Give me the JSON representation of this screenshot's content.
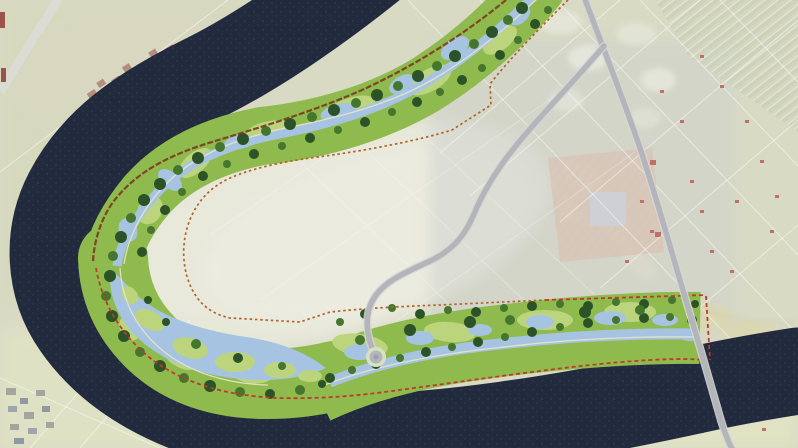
{
  "meta": {
    "view": "aerial-masterplan",
    "subject": "river-bend-wetland-park-plan-over-satellite-farmland",
    "visible_text": "none"
  },
  "palette": {
    "field-base": "#d2d4ba",
    "field-pale": "#e6e6d8",
    "field-gray": "#c8cac4",
    "field-yellow": "#e2e4bb",
    "field-green": "#ced3af",
    "river": "#222b3d",
    "river-speck": "#35415d",
    "park-base": "#8fba4e",
    "park-light": "#bcd57d",
    "tree-dark": "#2c5328",
    "tree-mid": "#44762f",
    "park-water": "#a6c4e2",
    "boundary-orange": "#b06428",
    "boundary-red": "#c0392b",
    "levee-brown": "#7c3a1e",
    "road-fill": "#b3b5ba",
    "road-case": "#d6d7d3",
    "stripe-a": "#ccd0b5",
    "stripe-b": "#c2c8ad",
    "pink-a": "#d8b8a6",
    "pink-b": "#cbc0b0",
    "village": "#a8786a",
    "village-dark": "#8a352c",
    "gray-square": "#c6c8cc",
    "sand": "#d5d1a2",
    "house-red": "#b5584a"
  },
  "features": [
    {
      "name": "river-channel",
      "kind": "water",
      "shape": "horseshoe-bend"
    },
    {
      "name": "wetland-park-strip",
      "kind": "designed-landscape",
      "elements": [
        "lagoon",
        "side-channels",
        "ponds",
        "tree-clusters",
        "islands",
        "trails"
      ]
    },
    {
      "name": "design-boundary-inner",
      "kind": "dotted-line",
      "color_key": "boundary-orange"
    },
    {
      "name": "design-boundary-river-edge",
      "kind": "dashed-line",
      "color_key": "boundary-red"
    },
    {
      "name": "levee-line",
      "kind": "line",
      "color_key": "levee-brown"
    },
    {
      "name": "main-road-with-bridge",
      "kind": "road"
    },
    {
      "name": "winding-park-access-road",
      "kind": "road",
      "terminus": "circular-lookout-node"
    },
    {
      "name": "farmland-grid",
      "kind": "fields"
    },
    {
      "name": "village-northwest",
      "kind": "buildings"
    },
    {
      "name": "village-southwest",
      "kind": "buildings"
    },
    {
      "name": "greenhouse-plot-east",
      "kind": "striped-farm-block"
    },
    {
      "name": "sandy-meander-scars-east",
      "kind": "terrain"
    }
  ]
}
